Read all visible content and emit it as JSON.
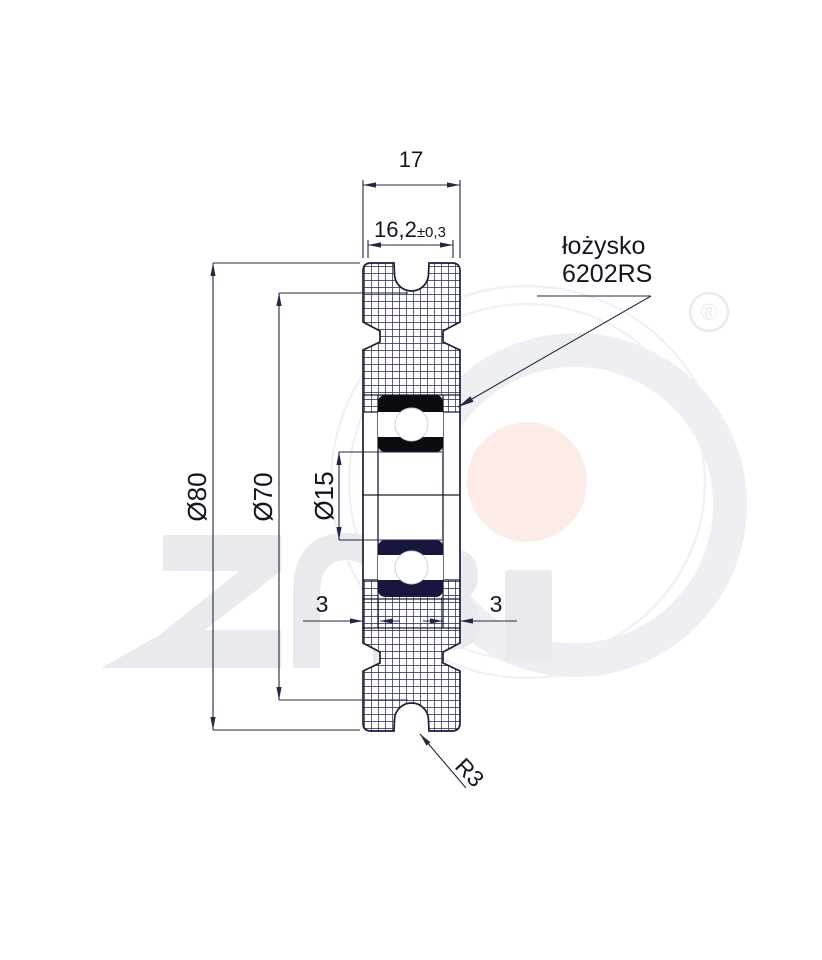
{
  "drawing": {
    "title_hint": "pulley cross-section technical drawing",
    "dims": {
      "top_width": "17",
      "groove_width": "16,2",
      "groove_width_tolerance": "±0,3",
      "outer_diameter": "Ø80",
      "root_diameter": "Ø70",
      "bore_diameter": "Ø15",
      "lip_left": "3",
      "lip_right": "3",
      "groove_radius": "R3"
    },
    "callout": {
      "line1": "łożysko",
      "line2": "6202RS"
    },
    "watermark": {
      "brand_letters": "ZABi",
      "registered_symbol": "®"
    },
    "colors": {
      "line": "#1a1d33",
      "dim_line": "#232741",
      "hatch": "#3c4160",
      "text": "#141420",
      "bearing_upper": "#0b0b10",
      "bearing_lower": "#16163e",
      "ball_outline": "#c9ced6",
      "watermark_gray": "#edeff2",
      "watermark_letters": "#e8eaee",
      "watermark_arc": "#eff1f5",
      "watermark_pink": "#fdebe8",
      "watermark_mark": "#e7eaee"
    }
  }
}
